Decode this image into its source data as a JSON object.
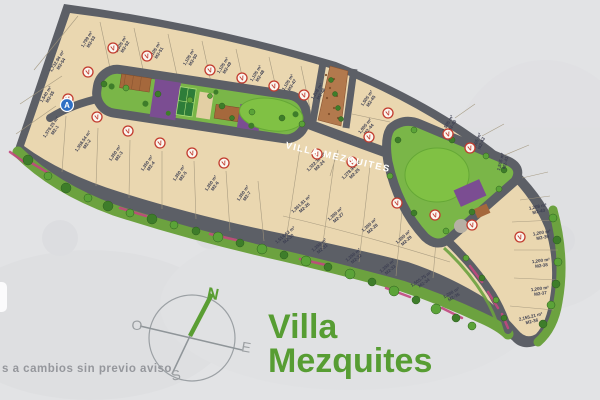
{
  "title": {
    "line1": "Villa",
    "line2": "Mezquites"
  },
  "disclaimer": "s a cambios sin previo aviso",
  "road_label": "VILLA MEZQUITES",
  "compass": {
    "n": "N",
    "s": "S",
    "e": "E",
    "o": "O"
  },
  "entrance_marker": "A",
  "sold_badge_letter": "V",
  "colors": {
    "title_green": "#579d33",
    "road_gray": "#5c5f66",
    "lot_tan": "#ead7b0",
    "strip_green": "#6ca23f",
    "park_green": "#80c144",
    "purple": "#7b4d92",
    "badge_red": "#c23b2e",
    "pink": "#c2487f",
    "marker_blue": "#2f6fc4"
  },
  "lots": [
    {
      "x": 88,
      "y": 40,
      "rot": -58,
      "size": "1,799 m²",
      "code": "M2-53"
    },
    {
      "x": 122,
      "y": 45,
      "rot": -58,
      "size": "1,505 m²",
      "code": "M2-52"
    },
    {
      "x": 156,
      "y": 51,
      "rot": -58,
      "size": "1,105 m²",
      "code": "M2-51"
    },
    {
      "x": 190,
      "y": 58,
      "rot": -58,
      "size": "1,105 m²",
      "code": "M2-50"
    },
    {
      "x": 224,
      "y": 66,
      "rot": -58,
      "size": "1,105 m²",
      "code": "M2-49"
    },
    {
      "x": 257,
      "y": 74,
      "rot": -58,
      "size": "1,105 m²",
      "code": "M2-48"
    },
    {
      "x": 289,
      "y": 83,
      "rot": -58,
      "size": "1,105 m²",
      "code": "M2-47"
    },
    {
      "x": 318,
      "y": 92,
      "rot": -58,
      "size": "1,208 m²",
      "code": "M2-46"
    },
    {
      "x": 58,
      "y": 62,
      "rot": -58,
      "size": "1,732.94 m²",
      "code": "M2-54"
    },
    {
      "x": 47,
      "y": 95,
      "rot": -58,
      "size": "1,540 m²",
      "code": "M2-55"
    },
    {
      "x": 52,
      "y": 128,
      "rot": -55,
      "size": "1,379.25 m²",
      "code": "M2-1"
    },
    {
      "x": 84,
      "y": 142,
      "rot": -55,
      "size": "1,358.54 m²",
      "code": "M2-2"
    },
    {
      "x": 116,
      "y": 154,
      "rot": -55,
      "size": "1,350 m²",
      "code": "M2-3"
    },
    {
      "x": 148,
      "y": 164,
      "rot": -55,
      "size": "1,350 m²",
      "code": "M2-4"
    },
    {
      "x": 180,
      "y": 174,
      "rot": -55,
      "size": "1,350 m²",
      "code": "M2-5"
    },
    {
      "x": 212,
      "y": 184,
      "rot": -55,
      "size": "1,350 m²",
      "code": "M2-6"
    },
    {
      "x": 244,
      "y": 194,
      "rot": -55,
      "size": "1,350 m²",
      "code": "M2-7"
    },
    {
      "x": 317,
      "y": 163,
      "rot": -45,
      "size": "1,322.36 m²",
      "code": "M2-24"
    },
    {
      "x": 352,
      "y": 171,
      "rot": -45,
      "size": "1,278.94 m²",
      "code": "M2-25"
    },
    {
      "x": 302,
      "y": 205,
      "rot": -42,
      "size": "1,361.81 m²",
      "code": "M2-26"
    },
    {
      "x": 336,
      "y": 215,
      "rot": -42,
      "size": "1,350 m²",
      "code": "M2-27"
    },
    {
      "x": 370,
      "y": 226,
      "rot": -42,
      "size": "1,350 m²",
      "code": "M2-28"
    },
    {
      "x": 404,
      "y": 238,
      "rot": -42,
      "size": "1,350 m²",
      "code": "M2-29"
    },
    {
      "x": 286,
      "y": 236,
      "rot": -40,
      "size": "1,514.62 m²",
      "code": "M2-30"
    },
    {
      "x": 320,
      "y": 246,
      "rot": -40,
      "size": "1,350 m²",
      "code": "M2-31"
    },
    {
      "x": 354,
      "y": 256,
      "rot": -40,
      "size": "1,350 m²",
      "code": "M2-32"
    },
    {
      "x": 388,
      "y": 267,
      "rot": -40,
      "size": "1,350 m²",
      "code": "M2-33"
    },
    {
      "x": 422,
      "y": 280,
      "rot": -35,
      "size": "1,505.75 m²",
      "code": "M2-34"
    },
    {
      "x": 452,
      "y": 294,
      "rot": -30,
      "size": "1,208 m²",
      "code": "M2-35"
    },
    {
      "x": 538,
      "y": 208,
      "rot": -12,
      "size": "1,208 m²",
      "code": "M2-40"
    },
    {
      "x": 542,
      "y": 234,
      "rot": -10,
      "size": "1,200 m²",
      "code": "M2-39"
    },
    {
      "x": 541,
      "y": 262,
      "rot": -8,
      "size": "1,200 m²",
      "code": "M2-38"
    },
    {
      "x": 540,
      "y": 290,
      "rot": -8,
      "size": "1,200 m²",
      "code": "M2-37"
    },
    {
      "x": 531,
      "y": 318,
      "rot": -14,
      "size": "2,155.21 m²",
      "code": "M2-36"
    },
    {
      "x": 449,
      "y": 124,
      "rot": -60,
      "size": "1,505 m²",
      "code": "M2-43"
    },
    {
      "x": 478,
      "y": 142,
      "rot": -68,
      "size": "1,505 m²",
      "code": "M2-42"
    },
    {
      "x": 502,
      "y": 162,
      "rot": -76,
      "size": "1,505 m²",
      "code": "M2-41"
    },
    {
      "x": 368,
      "y": 99,
      "rot": -55,
      "size": "1,505 m²",
      "code": "M2-45"
    },
    {
      "x": 366,
      "y": 127,
      "rot": -50,
      "size": "1,005 m²",
      "code": "M2-44"
    }
  ],
  "sold_badges": [
    [
      113,
      48
    ],
    [
      147,
      56
    ],
    [
      210,
      70
    ],
    [
      242,
      78
    ],
    [
      274,
      86
    ],
    [
      304,
      95
    ],
    [
      88,
      72
    ],
    [
      68,
      99
    ],
    [
      97,
      117
    ],
    [
      128,
      131
    ],
    [
      160,
      143
    ],
    [
      192,
      153
    ],
    [
      224,
      163
    ],
    [
      317,
      154
    ],
    [
      352,
      162
    ],
    [
      388,
      113
    ],
    [
      369,
      137
    ],
    [
      448,
      134
    ],
    [
      470,
      148
    ],
    [
      397,
      203
    ],
    [
      435,
      215
    ],
    [
      472,
      225
    ],
    [
      520,
      237
    ]
  ],
  "trees": [
    [
      28,
      160,
      5,
      0
    ],
    [
      48,
      176,
      4,
      1
    ],
    [
      66,
      188,
      5,
      0
    ],
    [
      88,
      198,
      4,
      1
    ],
    [
      108,
      206,
      5,
      0
    ],
    [
      130,
      213,
      4,
      1
    ],
    [
      152,
      219,
      5,
      0
    ],
    [
      174,
      225,
      4,
      1
    ],
    [
      196,
      231,
      4,
      0
    ],
    [
      218,
      237,
      5,
      1
    ],
    [
      240,
      243,
      4,
      0
    ],
    [
      262,
      249,
      5,
      1
    ],
    [
      284,
      255,
      4,
      0
    ],
    [
      306,
      261,
      5,
      1
    ],
    [
      328,
      267,
      4,
      0
    ],
    [
      350,
      274,
      5,
      1
    ],
    [
      372,
      282,
      4,
      0
    ],
    [
      394,
      291,
      5,
      1
    ],
    [
      416,
      300,
      4,
      0
    ],
    [
      436,
      309,
      5,
      1
    ],
    [
      456,
      318,
      4,
      0
    ],
    [
      472,
      326,
      4,
      1
    ],
    [
      553,
      218,
      4,
      1
    ],
    [
      557,
      240,
      4,
      0
    ],
    [
      558,
      262,
      4,
      1
    ],
    [
      556,
      284,
      4,
      0
    ],
    [
      551,
      305,
      4,
      1
    ],
    [
      543,
      324,
      4,
      0
    ],
    [
      466,
      258,
      3,
      1
    ],
    [
      482,
      278,
      3,
      0
    ],
    [
      496,
      300,
      3,
      1
    ],
    [
      504,
      318,
      3,
      0
    ],
    [
      331,
      80,
      2.5,
      0
    ],
    [
      335,
      94,
      2.5,
      0
    ],
    [
      338,
      108,
      2.5,
      0
    ],
    [
      341,
      119,
      2.5,
      0
    ],
    [
      398,
      140,
      3,
      0
    ],
    [
      414,
      130,
      3,
      1
    ],
    [
      452,
      140,
      3,
      0
    ],
    [
      486,
      156,
      3,
      1
    ],
    [
      504,
      170,
      3,
      0
    ],
    [
      499,
      189,
      3,
      1
    ],
    [
      472,
      212,
      3,
      0
    ],
    [
      446,
      231,
      3,
      1
    ],
    [
      414,
      213,
      3,
      0
    ],
    [
      390,
      176,
      3,
      1
    ],
    [
      104,
      84,
      3,
      0
    ],
    [
      126,
      88,
      3,
      1
    ],
    [
      158,
      94,
      3,
      0
    ],
    [
      190,
      100,
      3,
      1
    ],
    [
      222,
      106,
      3,
      0
    ],
    [
      252,
      112,
      3,
      1
    ],
    [
      282,
      118,
      3,
      0
    ],
    [
      302,
      124,
      3,
      1
    ],
    [
      232,
      118,
      2.5,
      0
    ],
    [
      210,
      96,
      2.5,
      1
    ]
  ],
  "pink_strips": [
    [
      30,
      162,
      50,
      174
    ],
    [
      120,
      208,
      146,
      216
    ],
    [
      210,
      234,
      236,
      240
    ],
    [
      300,
      259,
      326,
      265
    ],
    [
      386,
      288,
      410,
      297
    ],
    [
      442,
      308,
      462,
      318
    ],
    [
      470,
      266,
      482,
      282
    ],
    [
      488,
      292,
      498,
      308
    ],
    [
      502,
      314,
      508,
      328
    ],
    [
      10,
      152,
      24,
      162
    ]
  ]
}
